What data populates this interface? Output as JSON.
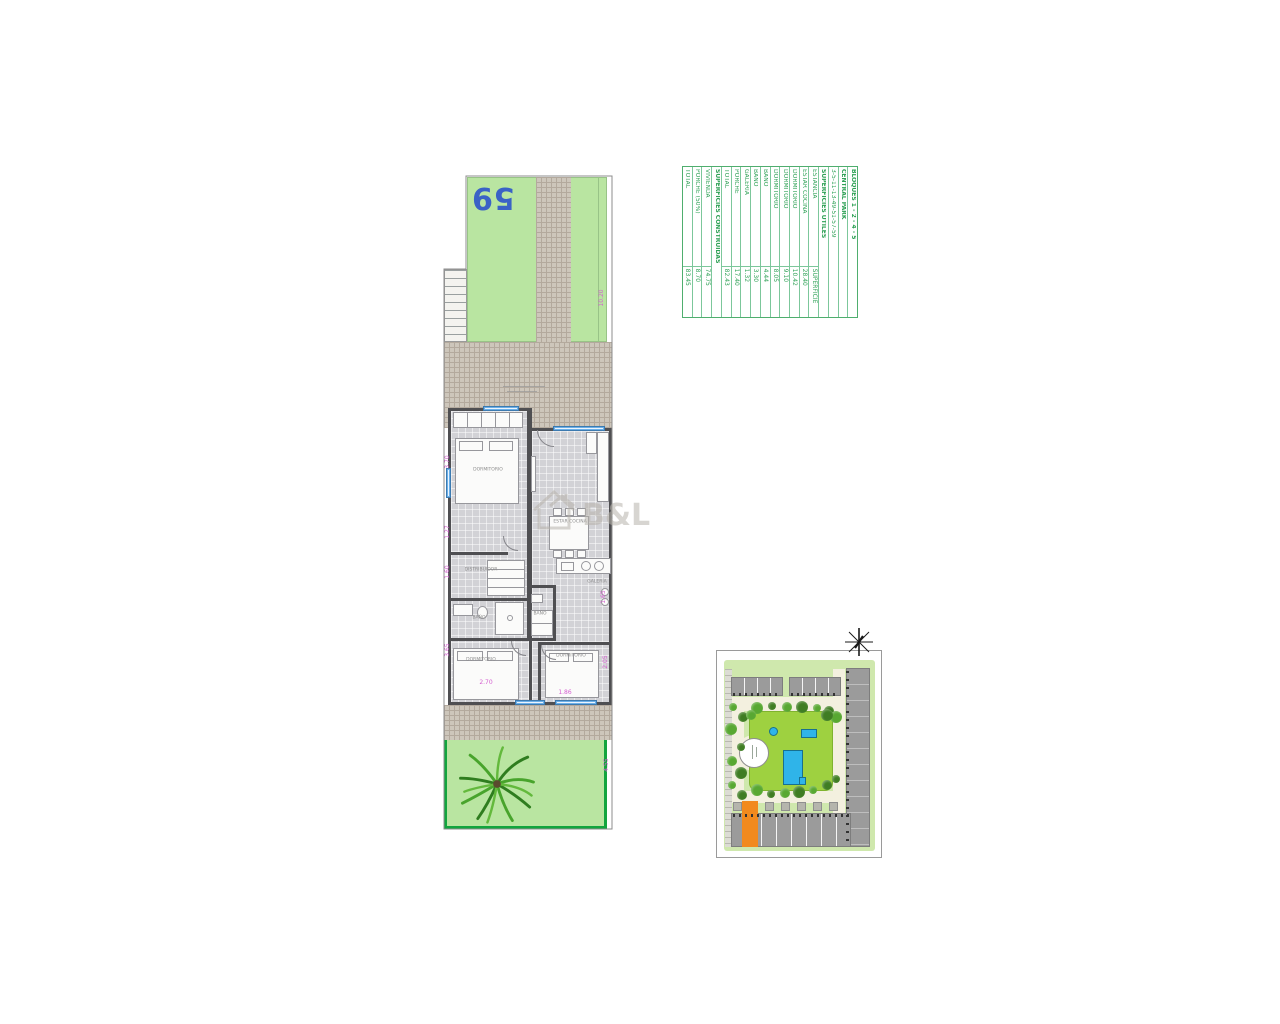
{
  "colors": {
    "plot_number_blue": "#3a62c6",
    "dimension_pink": "#d45fd0",
    "table_green": "#2fa156",
    "garden_green": "#b9e5a1",
    "park_green": "#9ed140",
    "pool_cyan": "#2fb4e9",
    "highlight_orange": "#f28a1e",
    "garden_border_green": "#12a53e"
  },
  "plan": {
    "plot_number": "59",
    "room_labels": [
      {
        "text": "DORMITORIO",
        "x": 47,
        "y": 300
      },
      {
        "text": "DISTRIBUIDOR",
        "x": 40,
        "y": 400
      },
      {
        "text": "BAÑO",
        "x": 38,
        "y": 448
      },
      {
        "text": "BAÑO",
        "x": 99,
        "y": 444
      },
      {
        "text": "ESTAR COCINA",
        "x": 129,
        "y": 352
      },
      {
        "text": "GALERÍA",
        "x": 156,
        "y": 412
      },
      {
        "text": "DORMITORIO",
        "x": 40,
        "y": 490
      },
      {
        "text": "DORMITORIO",
        "x": 130,
        "y": 486
      }
    ],
    "dimensions": [
      {
        "text": "10.20",
        "x": 161,
        "y": 128,
        "vertical": true
      },
      {
        "text": "3.70",
        "x": 7,
        "y": 292,
        "vertical": true
      },
      {
        "text": "1.27",
        "x": 7,
        "y": 362,
        "vertical": true
      },
      {
        "text": "1.60",
        "x": 7,
        "y": 402,
        "vertical": true
      },
      {
        "text": "3.65",
        "x": 7,
        "y": 480,
        "vertical": true
      },
      {
        "text": "2.70",
        "x": 45,
        "y": 513,
        "vertical": false
      },
      {
        "text": "1.86",
        "x": 124,
        "y": 523,
        "vertical": false
      },
      {
        "text": "2.05",
        "x": 165,
        "y": 492,
        "vertical": true
      },
      {
        "text": "1.65",
        "x": 163,
        "y": 427,
        "vertical": true
      },
      {
        "text": "4.55",
        "x": 166,
        "y": 595,
        "vertical": true
      }
    ]
  },
  "table": {
    "header_block": "BLOQUES 1 - 2 - 4 - 5",
    "header_name": "CENTRAL PARK",
    "header_units": "3-5-11-13-49-51-57-59",
    "header_useful": "SUPERFICIES ÚTILES",
    "col_headers": [
      "ESTANCIA",
      "SUPERFICIE"
    ],
    "useful_rows": [
      {
        "name": "ESTAR COCINA",
        "value": "28.40"
      },
      {
        "name": "DORMITORIO",
        "value": "10.42"
      },
      {
        "name": "DORMITORIO",
        "value": "9.10"
      },
      {
        "name": "DORMITORIO",
        "value": "8.05"
      },
      {
        "name": "BAÑO",
        "value": "4.44"
      },
      {
        "name": "BAÑO",
        "value": "3.30"
      },
      {
        "name": "GALERÍA",
        "value": "1.32"
      },
      {
        "name": "PORCHE",
        "value": "17.40"
      },
      {
        "name": "TOTAL",
        "value": "82.43"
      }
    ],
    "header_built": "SUPERFICIES CONSTRUIDAS",
    "built_rows": [
      {
        "name": "VIVIENDA",
        "value": "74.75"
      },
      {
        "name": "PORCHE (50%)",
        "value": "8.70"
      },
      {
        "name": "TOTAL",
        "value": "83.45"
      }
    ]
  },
  "watermark": {
    "text": "B&L"
  }
}
